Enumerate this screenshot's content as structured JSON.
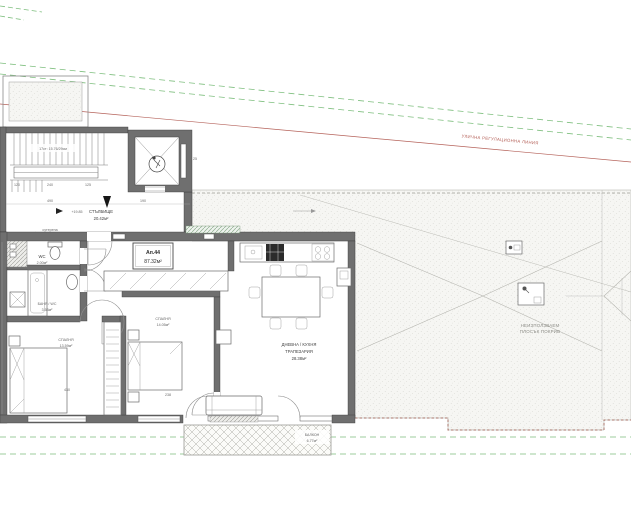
{
  "site": {
    "regulation_line_label": "УЛИЧНА РЕГУЛАЦИОННА ЛИНИЯ"
  },
  "stairwell": {
    "room": "СТЪЛБИЩЕ",
    "area": "20.42м²",
    "stairs_note": "17ст: 15.76/29см",
    "level_mark": "+19.85",
    "basement_note": "сутерена"
  },
  "apartment": {
    "number": "Ап.44",
    "area": "87.32м²"
  },
  "rooms": {
    "wc": {
      "name": "WC",
      "area": "2.00м²"
    },
    "bath": {
      "name": "БАНЯ / WC",
      "area": "3.53м²"
    },
    "bedroom1": {
      "name": "СПАЛНЯ",
      "area": "13.59м²"
    },
    "bedroom2": {
      "name": "СПАЛНЯ",
      "area": "14.05м²"
    },
    "living": {
      "name_line1": "ДНЕВНА / КУХНЯ",
      "name_line2": "ТРАПЕЗАРИЯ",
      "area": "28.38м²"
    },
    "balcony": {
      "name": "БАЛКОН",
      "area": "6.77м²"
    }
  },
  "roof": {
    "note_line1": "НЕИЗПОЛЗВАЕМ",
    "note_line2": "ПЛОСЪК ПОКРИВ"
  },
  "dimensions": {
    "landing_width": "490",
    "elevator_width": "190",
    "stair_d1": "120",
    "stair_d2": "240",
    "stair_d3": "125",
    "wall_thickness": "25",
    "bedroom1_width": "430",
    "bedroom2_width": "238"
  },
  "colors": {
    "wall": "#6f6f6f",
    "regulation_red": "#b5625a",
    "regulation_green": "#7fbf7f",
    "roof_dot": "#c6c6c0",
    "text": "#3c3c3c"
  }
}
